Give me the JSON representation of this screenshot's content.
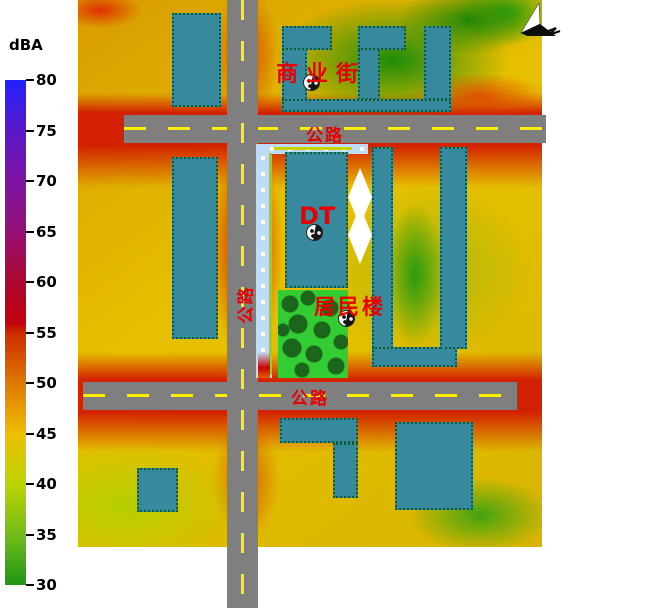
{
  "legend": {
    "title": "dBA",
    "scale": [
      {
        "db": "80",
        "color": "#2222FF"
      },
      {
        "db": "75",
        "color": "#5A18C8"
      },
      {
        "db": "70",
        "color": "#7E14A4"
      },
      {
        "db": "65",
        "color": "#951078"
      },
      {
        "db": "60",
        "color": "#AC0830"
      },
      {
        "db": "55",
        "color": "#C20010"
      },
      {
        "db": "50",
        "color": "#E07800"
      },
      {
        "db": "45",
        "color": "#EEBE00"
      },
      {
        "db": "40",
        "color": "#BCD400"
      },
      {
        "db": "35",
        "color": "#74BC1A"
      },
      {
        "db": "30",
        "color": "#1E9614"
      }
    ]
  },
  "labels": {
    "commercial_street": "商业街",
    "road_top": "公路",
    "road_vertical": "公路",
    "road_bottom": "公路",
    "dt_building": "DT",
    "residential_building": "居民楼"
  },
  "icons": {
    "north_arrow": "north-arrow-icon",
    "point_source": "point-source-icon"
  },
  "colors": {
    "building": "#37899E",
    "road": "#7F7F7F",
    "road_dash": "#FFEE00",
    "noise_barrier": "#BFDCF6",
    "barrier_line": "#9ACD32",
    "park_green": "#33CC33",
    "tree_green": "#1B661B",
    "label_red": "#E80000",
    "quiet_zone": "#FFFFFF"
  }
}
